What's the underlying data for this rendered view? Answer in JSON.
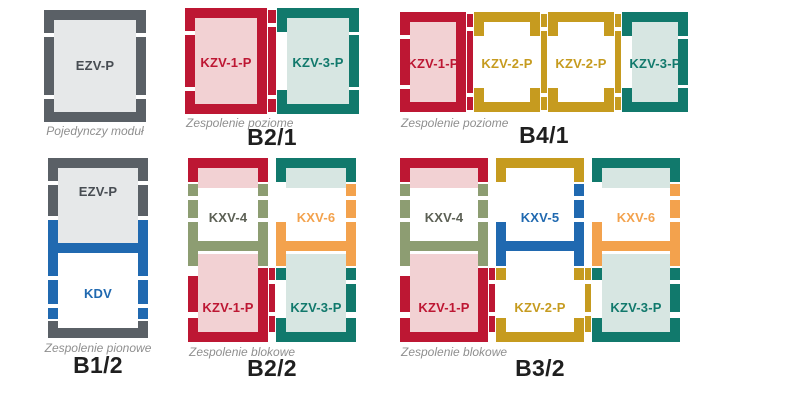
{
  "colors": {
    "red": "#bd1733",
    "pink": "#f2d1d3",
    "teal": "#11796c",
    "tealLight": "#d7e6e2",
    "gold": "#c69b1f",
    "olive": "#8d9d72",
    "orange": "#f3a24d",
    "blue": "#2069b0",
    "gray": "#5a6066",
    "grayLight": "#e6e8e9",
    "white": "#ffffff",
    "dim": "#5c6055",
    "grayDark": "#474c52",
    "caption": "#8f8f8f",
    "title": "#1f1f1f",
    "background": "#ffffff"
  },
  "panels": [
    {
      "id": "single",
      "caption": "Pojedynczy moduł",
      "title": "",
      "modules": [
        {
          "row": 0,
          "col": 0,
          "kind": "single",
          "label": "EZV-P",
          "frame": "gray",
          "fill": "grayLight",
          "label_color": "grayDark"
        }
      ]
    },
    {
      "id": "b21",
      "caption": "Zespolenie poziome",
      "title": "B2/1",
      "modules": [
        {
          "row": 0,
          "col": 0,
          "kind": "hleft",
          "label": "KZV-1-P",
          "frame": "red",
          "fill": "pink",
          "label_color": "red"
        },
        {
          "row": 0,
          "col": 1,
          "kind": "hright",
          "label": "KZV-3-P",
          "frame": "teal",
          "fill": "tealLight",
          "label_color": "teal"
        }
      ]
    },
    {
      "id": "b41",
      "caption": "Zespolenie poziome",
      "title": "B4/1",
      "modules": [
        {
          "row": 0,
          "col": 0,
          "kind": "hleft",
          "label": "KZV-1-P",
          "frame": "red",
          "fill": "pink",
          "label_color": "red"
        },
        {
          "row": 0,
          "col": 1,
          "kind": "hmid",
          "label": "KZV-2-P",
          "frame": "gold",
          "fill": "white",
          "label_color": "gold"
        },
        {
          "row": 0,
          "col": 2,
          "kind": "hmid",
          "label": "KZV-2-P",
          "frame": "gold",
          "fill": "white",
          "label_color": "gold"
        },
        {
          "row": 0,
          "col": 3,
          "kind": "hright",
          "label": "KZV-3-P",
          "frame": "teal",
          "fill": "tealLight",
          "label_color": "teal"
        }
      ]
    },
    {
      "id": "b12",
      "caption": "Zespolenie pionowe",
      "title": "B1/2",
      "modules": [
        {
          "row": 0,
          "col": 0,
          "kind": "vtop",
          "label": "EZV-P",
          "frame": "gray",
          "fill": "grayLight",
          "label_color": "grayDark"
        },
        {
          "row": 1,
          "col": 0,
          "kind": "vbottom",
          "label": "KDV",
          "frame": "blue",
          "fill": "white",
          "label_color": "blue",
          "bottom": "gray"
        }
      ]
    },
    {
      "id": "b22",
      "caption": "Zespolenie blokowe",
      "title": "B2/2",
      "modules": [
        {
          "row": 0,
          "col": 0,
          "kind": "btop",
          "label": "KXV-4",
          "top": "red",
          "band": "pink",
          "side": "olive",
          "label_color": "dim"
        },
        {
          "row": 0,
          "col": 1,
          "kind": "btop",
          "label": "KXV-6",
          "top": "teal",
          "band": "tealLight",
          "side": "orange",
          "label_color": "orange"
        },
        {
          "row": 1,
          "col": 0,
          "kind": "bbl",
          "label": "KZV-1-P",
          "frame": "red",
          "fill": "pink",
          "label_color": "red"
        },
        {
          "row": 1,
          "col": 1,
          "kind": "bbr",
          "label": "KZV-3-P",
          "frame": "teal",
          "fill": "tealLight",
          "label_color": "teal"
        }
      ]
    },
    {
      "id": "b32",
      "caption": "Zespolenie blokowe",
      "title": "B3/2",
      "modules": [
        {
          "row": 0,
          "col": 0,
          "kind": "btop",
          "label": "KXV-4",
          "top": "red",
          "band": "pink",
          "side": "olive",
          "label_color": "dim"
        },
        {
          "row": 0,
          "col": 1,
          "kind": "btop",
          "label": "KXV-5",
          "top": "gold",
          "band": "",
          "side": "blue",
          "label_color": "blue"
        },
        {
          "row": 0,
          "col": 2,
          "kind": "btop",
          "label": "KXV-6",
          "top": "teal",
          "band": "tealLight",
          "side": "orange",
          "label_color": "orange"
        },
        {
          "row": 1,
          "col": 0,
          "kind": "bbl",
          "label": "KZV-1-P",
          "frame": "red",
          "fill": "pink",
          "label_color": "red"
        },
        {
          "row": 1,
          "col": 1,
          "kind": "bbm",
          "label": "KZV-2-P",
          "frame": "gold",
          "fill": "white",
          "label_color": "gold"
        },
        {
          "row": 1,
          "col": 2,
          "kind": "bbr",
          "label": "KZV-3-P",
          "frame": "teal",
          "fill": "tealLight",
          "label_color": "teal"
        }
      ]
    }
  ]
}
